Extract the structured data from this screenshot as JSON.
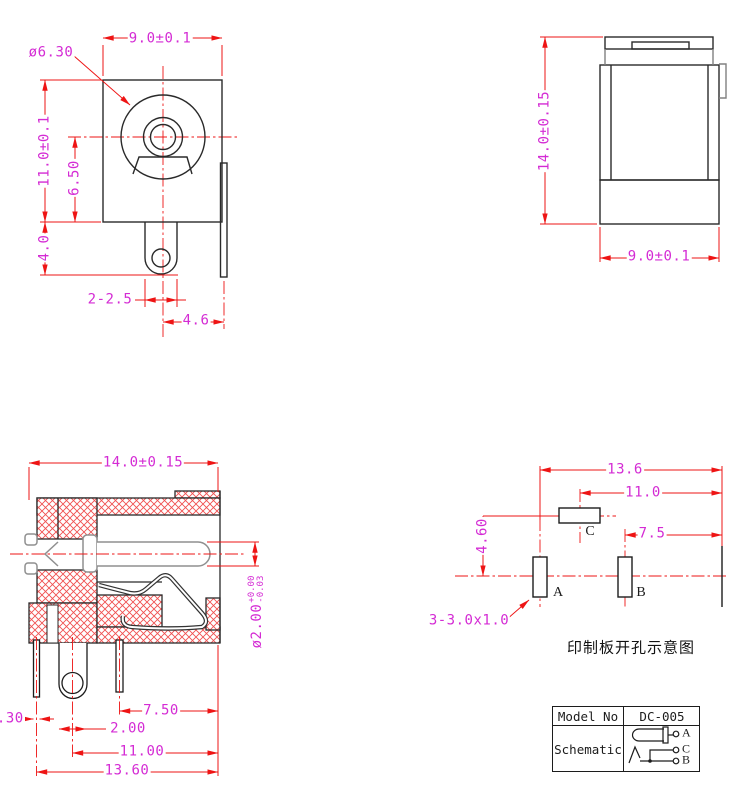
{
  "front_view": {
    "barrel_dia": "ø6.30",
    "width": "9.0±0.1",
    "height": "11.0±0.1",
    "center_height": "6.50",
    "lug_length": "4.0",
    "lug_width": "2-2.5",
    "pin_offset": "4.6"
  },
  "side_view": {
    "height": "14.0±0.15",
    "width": "9.0±0.1"
  },
  "section_view": {
    "length": "14.0±0.15",
    "pin_dia": "ø2.00",
    "pin_tol_plus": "+0.00",
    "pin_tol_minus": "-0.03",
    "terminal_thickness": "0.30",
    "pitch_b": "7.50",
    "lug_width": "2.00",
    "pitch_a": "11.00",
    "overall": "13.60"
  },
  "pcb_view": {
    "overall": "13.6",
    "pitch_c": "11.0",
    "pitch_b": "7.5",
    "offset_c": "4.60",
    "slot_note": "3-3.0x1.0",
    "hole_a": "A",
    "hole_b": "B",
    "hole_c": "C",
    "caption": "印制板开孔示意图"
  },
  "title_block": {
    "model_label": "Model No",
    "model_value": "DC-005",
    "schematic_label": "Schematic",
    "terminal_a": "A",
    "terminal_c": "C",
    "terminal_b": "B"
  },
  "colors": {
    "dimension_line": "#ee1414",
    "dimension_text": "#d42bd4",
    "outline": "#2a2a2a",
    "hatch": "#f05050",
    "pin_gray": "#8f8f8f"
  }
}
